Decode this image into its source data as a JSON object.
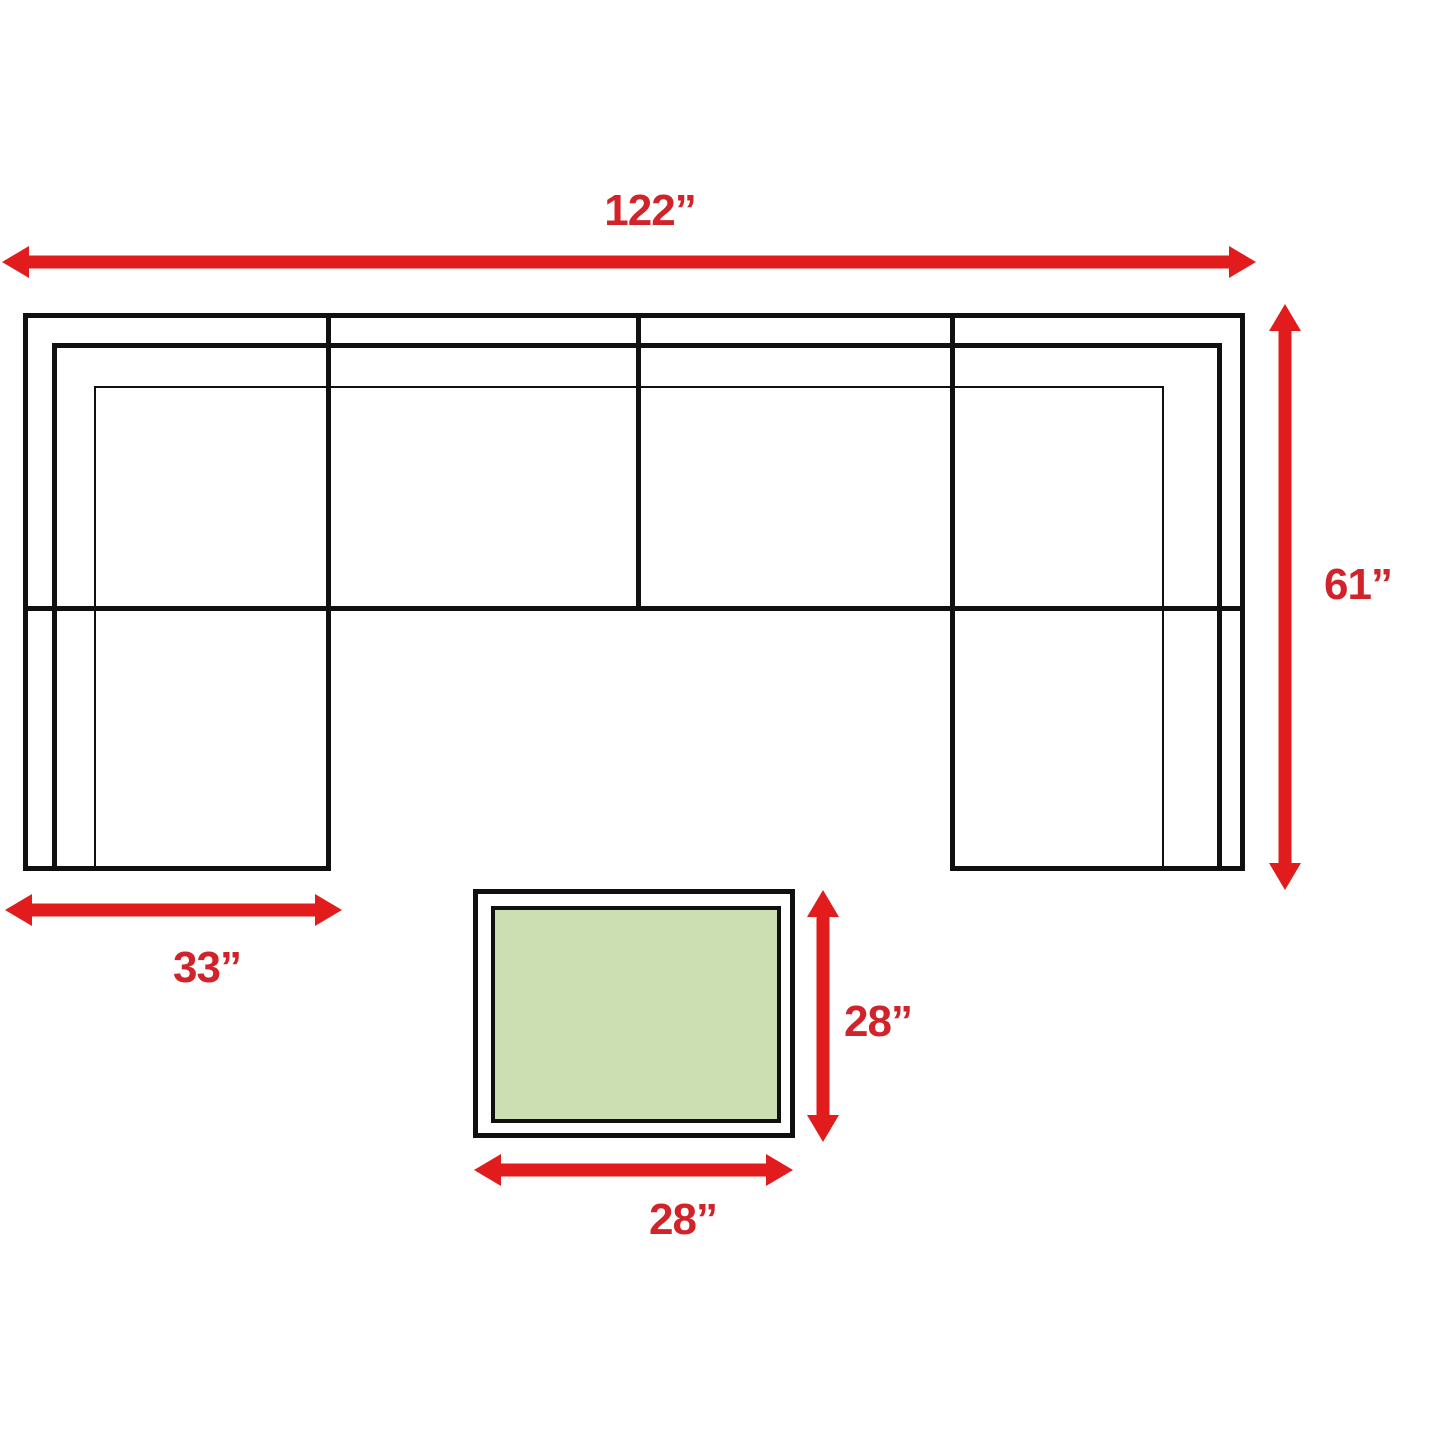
{
  "diagram": {
    "type": "furniture-dimension-plan",
    "description": "Top view of a U-shaped sectional sofa with two chaises and a square ottoman coffee table, annotated with red dimension arrows",
    "labels": {
      "overall_width": "122”",
      "overall_depth": "61”",
      "chaise_width": "33”",
      "table_depth": "28”",
      "table_width": "28”"
    },
    "values_inches": {
      "overall_width": 122,
      "overall_depth": 61,
      "chaise_width": 33,
      "table_depth": 28,
      "table_width": 28
    },
    "colors": {
      "arrow": "#e21c1c",
      "label": "#d2232a",
      "outline": "#101010",
      "table_top": "#cbdfb2",
      "background": "#ffffff"
    }
  }
}
